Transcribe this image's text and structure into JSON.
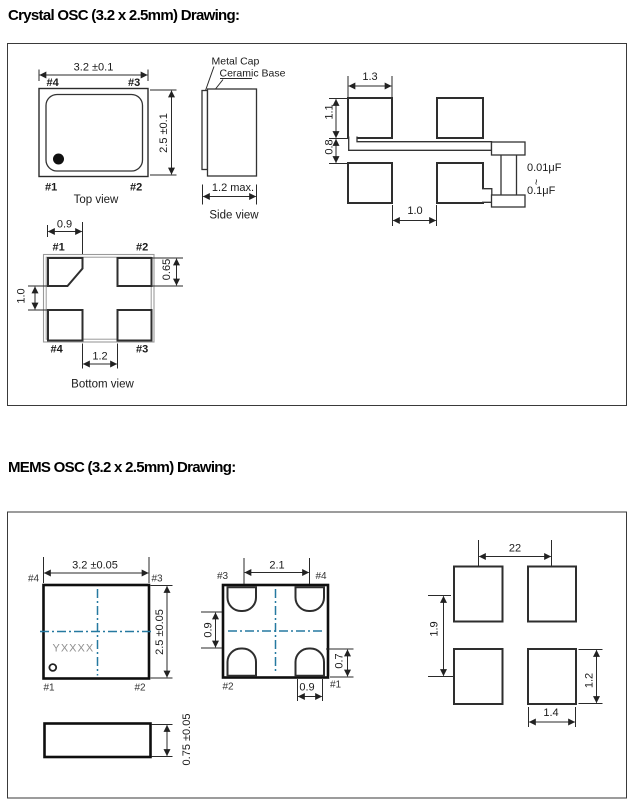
{
  "colors": {
    "accent_blue": "#2579a0",
    "marking_gray": "#8f8f8f"
  },
  "crystal": {
    "title": "Crystal OSC (3.2 x 2.5mm) Drawing:",
    "top_view": {
      "caption": "Top view",
      "dim_width": "3.2 ±0.1",
      "dim_height": "2.5 ±0.1",
      "pin_top_left": "#4",
      "pin_top_right": "#3",
      "pin_bottom_left": "#1",
      "pin_bottom_right": "#2"
    },
    "side_view": {
      "caption": "Side view",
      "label_metal_cap": "Metal Cap",
      "label_ceramic_base": "Ceramic Base",
      "dim_thickness": "1.2 max."
    },
    "bottom_view": {
      "caption": "Bottom view",
      "dim_pad_width": "0.9",
      "dim_pad_gap_vertical": "1.0",
      "dim_pad_height": "0.65",
      "dim_pad_gap_horizontal": "1.2",
      "pin_top_left": "#1",
      "pin_top_right": "#2",
      "pin_bottom_left": "#4",
      "pin_bottom_right": "#3"
    },
    "land_pattern": {
      "dim_pad_width": "1.3",
      "dim_pad_height": "1.1",
      "dim_row_gap": "0.8",
      "dim_col_gap": "1.0",
      "capacitor_min": "0.01μF",
      "capacitor_range_tilde": "~",
      "capacitor_max": "0.1μF"
    }
  },
  "mems": {
    "title": "MEMS OSC (3.2 x 2.5mm) Drawing:",
    "top_view": {
      "dim_width": "3.2 ±0.05",
      "dim_height": "2.5 ±0.05",
      "marking": "YXXXX",
      "pin_top_left": "#4",
      "pin_top_right": "#3",
      "pin_bottom_left": "#1",
      "pin_bottom_right": "#2"
    },
    "bottom_view": {
      "dim_width": "2.1",
      "dim_pad_gap_vertical": "0.9",
      "dim_pad_height": "0.7",
      "dim_pad_width": "0.9",
      "pin_top_left": "#3",
      "pin_top_right": "#4",
      "pin_bottom_left": "#2",
      "pin_bottom_right": "#1"
    },
    "side_view": {
      "dim_thickness": "0.75 ±0.05"
    },
    "land_pattern": {
      "dim_pitch_horizontal": "22",
      "dim_pitch_vertical": "1.9",
      "dim_pad_height": "1.2",
      "dim_pad_width": "1.4"
    }
  }
}
